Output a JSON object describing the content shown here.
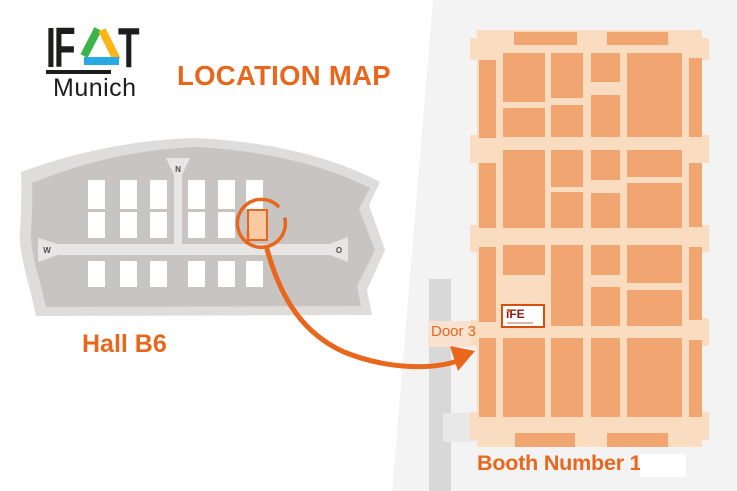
{
  "logo": {
    "text_left": "IF",
    "text_right": "T",
    "city": "Munich",
    "triangle_colors": {
      "green": "#3bb54a",
      "yellow": "#fdb515",
      "blue": "#27aae1"
    }
  },
  "title": {
    "text": "LOCATION MAP",
    "color": "#e8671d"
  },
  "overview": {
    "hall_label": "Hall B6",
    "compass": {
      "north": "N",
      "west": "W",
      "east": "O"
    },
    "columns": [
      70,
      102,
      132,
      170,
      200,
      228
    ],
    "hall_width": 17,
    "rows": [
      {
        "y": 52,
        "h": 29
      },
      {
        "y": 84,
        "h": 26
      },
      {
        "y": 133,
        "h": 26
      }
    ],
    "highlight": {
      "x": 230,
      "y": 82,
      "w": 19,
      "h": 30,
      "fill": "#f9c9a2",
      "stroke": "#e8671d"
    }
  },
  "detail": {
    "door_label": "Door 3",
    "booth_label": "Booth Number 139",
    "booth_logo": "iFE",
    "floor": [
      7,
      2,
      225,
      417
    ],
    "ife_booth": [
      31,
      276,
      44,
      24
    ],
    "bumps": [
      [
        0,
        10,
        10,
        22
      ],
      [
        0,
        107,
        10,
        28
      ],
      [
        0,
        197,
        10,
        27
      ],
      [
        0,
        292,
        10,
        25
      ],
      [
        0,
        384,
        10,
        28
      ],
      [
        229,
        10,
        10,
        22
      ],
      [
        229,
        107,
        10,
        28
      ],
      [
        229,
        197,
        10,
        27
      ],
      [
        229,
        290,
        10,
        28
      ],
      [
        229,
        384,
        10,
        28
      ]
    ],
    "booths": [
      [
        9,
        32,
        17,
        78
      ],
      [
        9,
        135,
        17,
        65
      ],
      [
        9,
        219,
        17,
        75
      ],
      [
        9,
        310,
        17,
        79
      ],
      [
        219,
        30,
        13,
        79
      ],
      [
        219,
        135,
        13,
        64
      ],
      [
        219,
        219,
        13,
        73
      ],
      [
        219,
        312,
        13,
        77
      ],
      [
        44,
        4,
        63,
        13
      ],
      [
        137,
        4,
        61,
        13
      ],
      [
        45,
        405,
        60,
        14
      ],
      [
        137,
        405,
        61,
        14
      ],
      [
        33,
        25,
        42,
        49
      ],
      [
        33,
        80,
        42,
        29
      ],
      [
        33,
        122,
        42,
        78
      ],
      [
        33,
        217,
        42,
        30
      ],
      [
        33,
        310,
        42,
        79
      ],
      [
        81,
        25,
        32,
        45
      ],
      [
        81,
        77,
        32,
        32
      ],
      [
        81,
        122,
        32,
        37
      ],
      [
        81,
        164,
        32,
        36
      ],
      [
        81,
        217,
        32,
        81
      ],
      [
        81,
        310,
        32,
        79
      ],
      [
        121,
        25,
        29,
        29
      ],
      [
        121,
        67,
        29,
        42
      ],
      [
        121,
        122,
        29,
        30
      ],
      [
        121,
        165,
        29,
        35
      ],
      [
        121,
        217,
        29,
        30
      ],
      [
        121,
        259,
        29,
        39
      ],
      [
        121,
        310,
        29,
        79
      ],
      [
        157,
        25,
        55,
        84
      ],
      [
        157,
        122,
        55,
        27
      ],
      [
        157,
        155,
        55,
        45
      ],
      [
        157,
        217,
        55,
        38
      ],
      [
        157,
        262,
        55,
        36
      ],
      [
        157,
        310,
        55,
        79
      ]
    ]
  },
  "colors": {
    "accent": "#e8671d",
    "floor": "#fadcc1",
    "booth": "#f1a571",
    "map_outer": "#dfdddc",
    "map_inner": "#c8c4c1",
    "corridor": "#e8e6e5",
    "gray_band": "#d9d8d9",
    "door_band": "#f9e2cf",
    "ife_text": "#8e1b12",
    "ife_border": "#d4500e",
    "bg_right": "#f4f3f4"
  }
}
